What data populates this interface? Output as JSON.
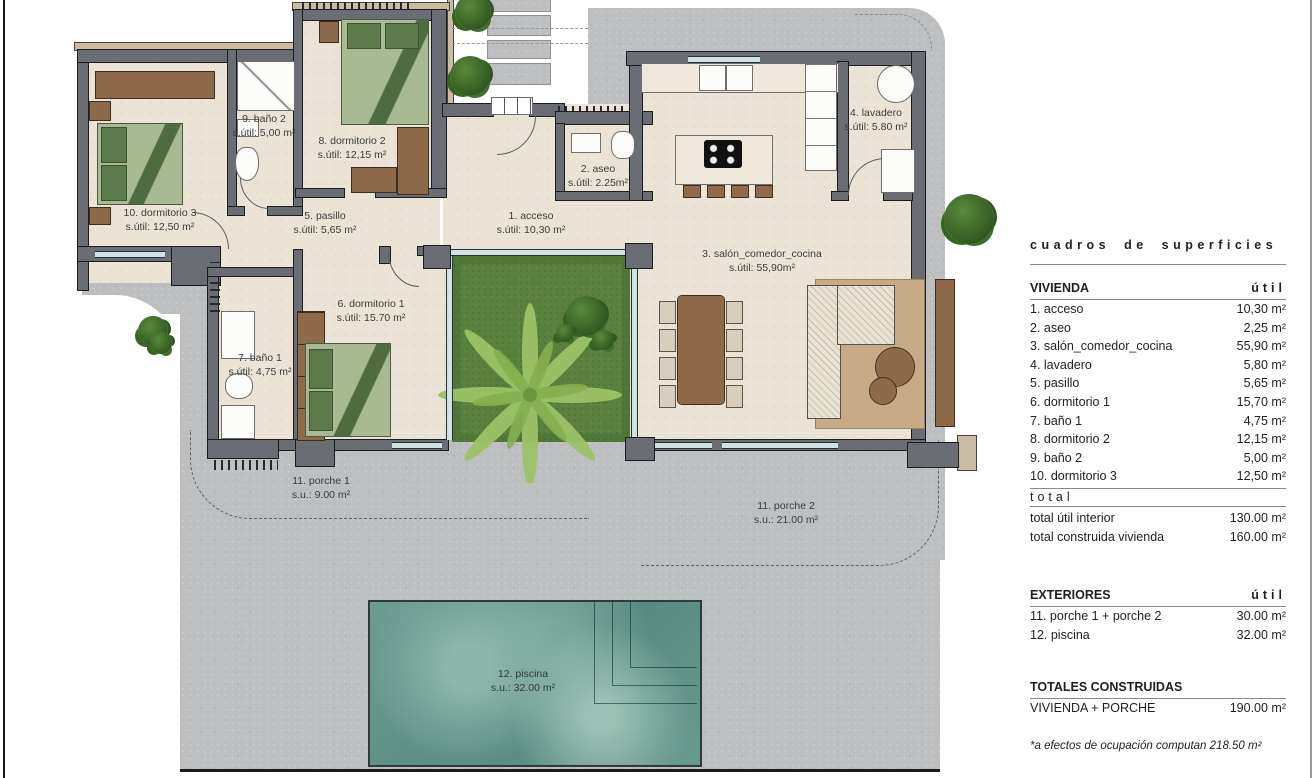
{
  "plan": {
    "rooms": {
      "acceso": {
        "name": "1. acceso",
        "area": "s.útil: 10,30 m²"
      },
      "aseo": {
        "name": "2. aseo",
        "area": "s.útil: 2.25m²"
      },
      "salon": {
        "name": "3. salón_comedor_cocina",
        "area": "s.útil: 55,90m²"
      },
      "lavadero": {
        "name": "4. lavadero",
        "area": "s.útil: 5.80 m²"
      },
      "pasillo": {
        "name": "5. pasillo",
        "area": "s.útil: 5,65 m²"
      },
      "dormitorio1": {
        "name": "6. dormitorio 1",
        "area": "s.útil: 15.70 m²"
      },
      "bano1": {
        "name": "7. baño 1",
        "area": "s.útil: 4,75 m²"
      },
      "dormitorio2": {
        "name": "8. dormitorio 2",
        "area": "s.útil: 12,15 m²"
      },
      "bano2": {
        "name": "9. baño 2",
        "area": "s.útil: 5,00 m²"
      },
      "dormitorio3": {
        "name": "10. dormitorio 3",
        "area": "s.útil: 12,50 m²"
      },
      "porche1": {
        "name": "11. porche 1",
        "area": "s.u.: 9.00 m²"
      },
      "porche2": {
        "name": "11. porche 2",
        "area": "s.u.: 21.00 m²"
      },
      "piscina": {
        "name": "12. piscina",
        "area": "s.u.: 32.00 m²"
      }
    }
  },
  "tables": {
    "title": "cuadros de superficies",
    "vivienda": {
      "header": "VIVIENDA",
      "unit_col": "útil",
      "rows": [
        {
          "label": "1. acceso",
          "value": "10,30 m²"
        },
        {
          "label": "2. aseo",
          "value": "2,25 m²"
        },
        {
          "label": "3. salón_comedor_cocina",
          "value": "55,90 m²"
        },
        {
          "label": "4. lavadero",
          "value": "5,80 m²"
        },
        {
          "label": "5. pasillo",
          "value": "5,65 m²"
        },
        {
          "label": "6. dormitorio 1",
          "value": "15,70 m²"
        },
        {
          "label": "7. baño 1",
          "value": "4,75 m²"
        },
        {
          "label": "8. dormitorio 2",
          "value": "12,15 m²"
        },
        {
          "label": "9. baño 2",
          "value": "5,00 m²"
        },
        {
          "label": "10. dormitorio 3",
          "value": "12,50 m²"
        }
      ],
      "total_label": "total",
      "totals": [
        {
          "label": "total útil interior",
          "value": "130.00 m²"
        },
        {
          "label": "total construida vivienda",
          "value": "160.00 m²"
        }
      ]
    },
    "exteriores": {
      "header": "EXTERIORES",
      "unit_col": "útil",
      "rows": [
        {
          "label": "11. porche 1 + porche 2",
          "value": "30.00 m²"
        },
        {
          "label": "12. piscina",
          "value": "32.00 m²"
        }
      ]
    },
    "totales": {
      "header": "TOTALES CONSTRUIDAS",
      "rows": [
        {
          "label": "VIVIENDA + PORCHE",
          "value": "190.00 m²"
        }
      ]
    },
    "footnote": "*a efectos de ocupación computan 218.50 m²"
  },
  "colors": {
    "wall": "#6a6e74",
    "floor": "#ebe4d6",
    "concrete": "#bdbec0",
    "grass": "#59803d",
    "pool": "#68998e",
    "wood": "#8d6b4a"
  }
}
